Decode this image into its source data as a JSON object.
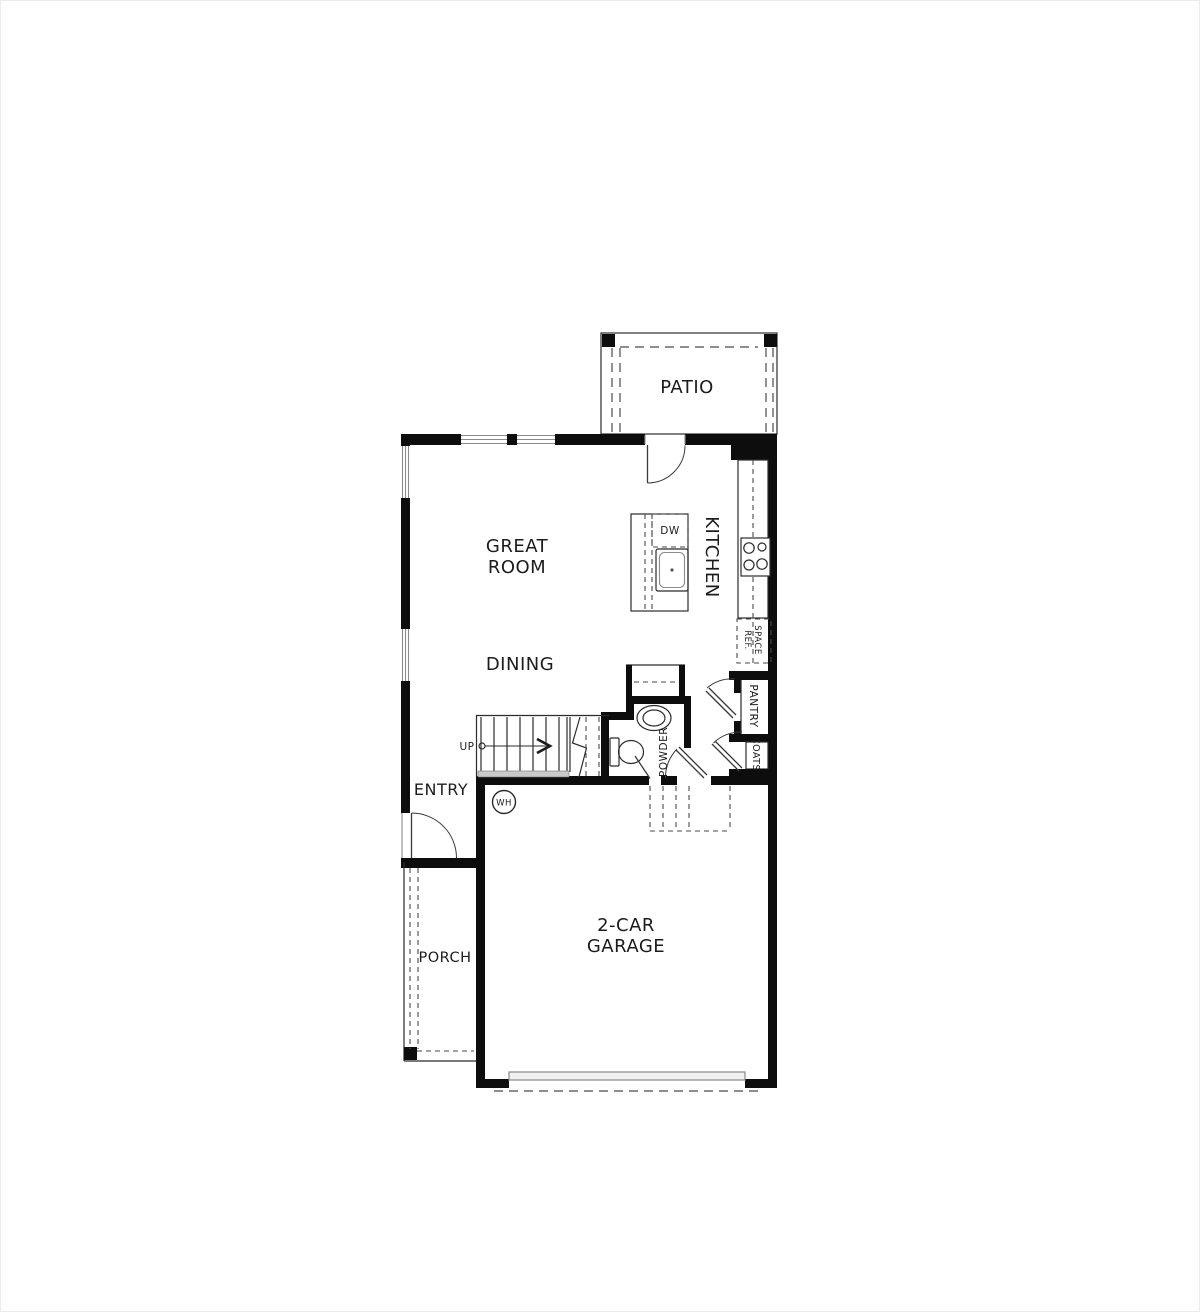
{
  "colors": {
    "wall": "#0d0d0d",
    "line": "#2b2b2b",
    "dashed_line": "#4a4a4a",
    "window_gray": "#8a8a8a",
    "stair_landing_gray": "#c9c9c9",
    "garage_door_fill": "#f0f0f0",
    "background": "#ffffff",
    "text": "#1c1c1c"
  },
  "plan": {
    "patio_label": "PATIO",
    "great_room_line1": "GREAT",
    "great_room_line2": "ROOM",
    "dining_label": "DINING",
    "kitchen_label": "KITCHEN",
    "entry_label": "ENTRY",
    "porch_label": "PORCH",
    "garage_line1": "2-CAR",
    "garage_line2": "GARAGE",
    "powder_label": "POWDER",
    "pantry_label": "PANTRY",
    "coats_label": "COATS",
    "ref_space_line1": "REF.",
    "ref_space_line2": "SPACE",
    "dishwasher_label": "DW",
    "up_label": "UP",
    "water_heater_label": "WH"
  }
}
